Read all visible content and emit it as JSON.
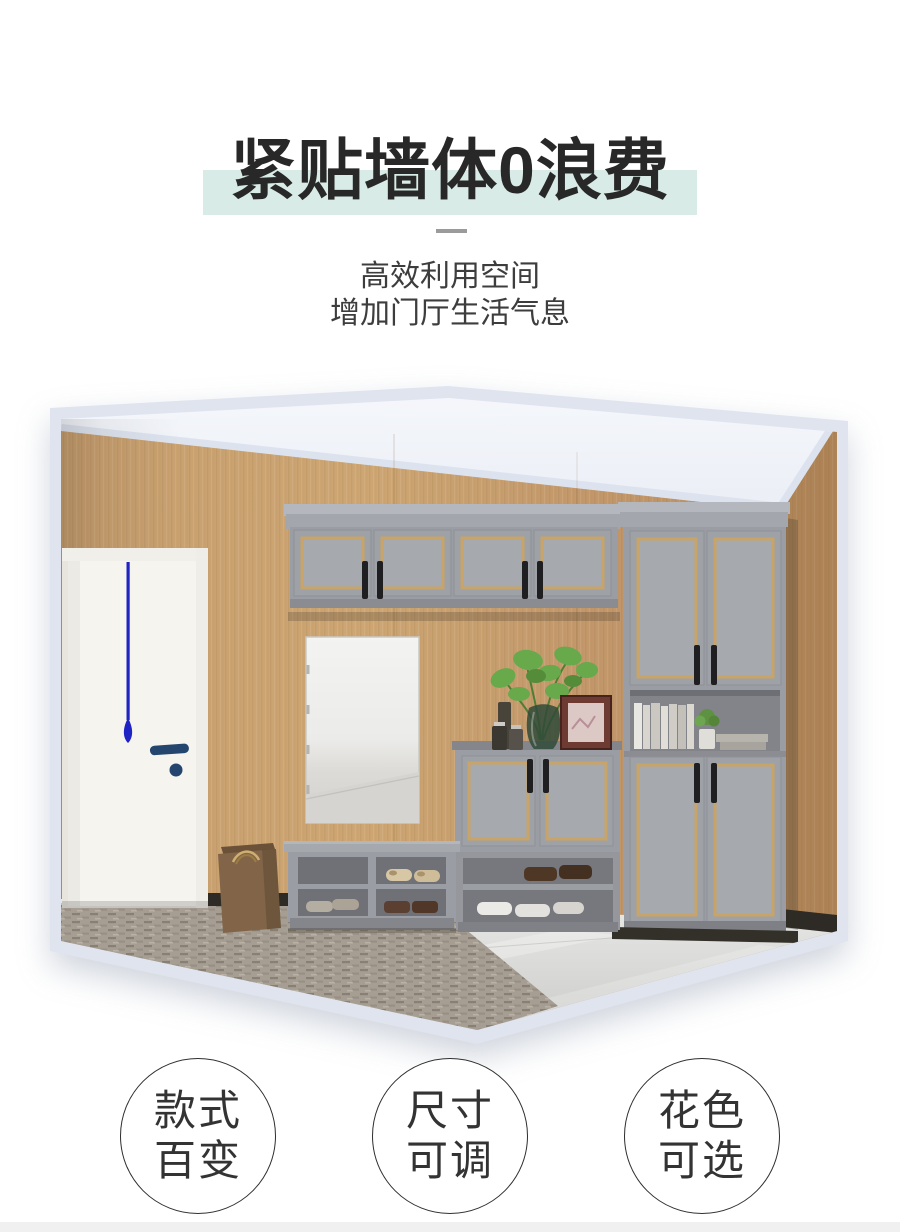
{
  "colors": {
    "mint": "#d8ebe6",
    "title": "#282828",
    "subtitle": "#3d3d3d",
    "divider": "#9b9b9b",
    "frame": "#dfe4ee",
    "footer-bar": "#f0f0f0",
    "badge-border": "#2f2f2f",
    "badge-text": "#333333",
    "wood": "#c89f6f",
    "cabinet": "#9a9da3",
    "cabinet-door": "#9ea1a6",
    "cabinet-panel": "#a6a9ae",
    "gold": "#c9a468",
    "handle": "#1f1f22",
    "carpet": "#a69e92",
    "door-white": "#f6f4ef",
    "door-blue": "#23456e",
    "string-blue": "#2023c4",
    "bag": "#826548"
  },
  "hero": {
    "title": "紧贴墙体0浪费",
    "subtitle_line1": "高效利用空间",
    "subtitle_line2": "增加门厅生活气息"
  },
  "features": [
    {
      "line1": "款式",
      "line2": "百变"
    },
    {
      "line1": "尺寸",
      "line2": "可调"
    },
    {
      "line1": "花色",
      "line2": "可选"
    }
  ]
}
